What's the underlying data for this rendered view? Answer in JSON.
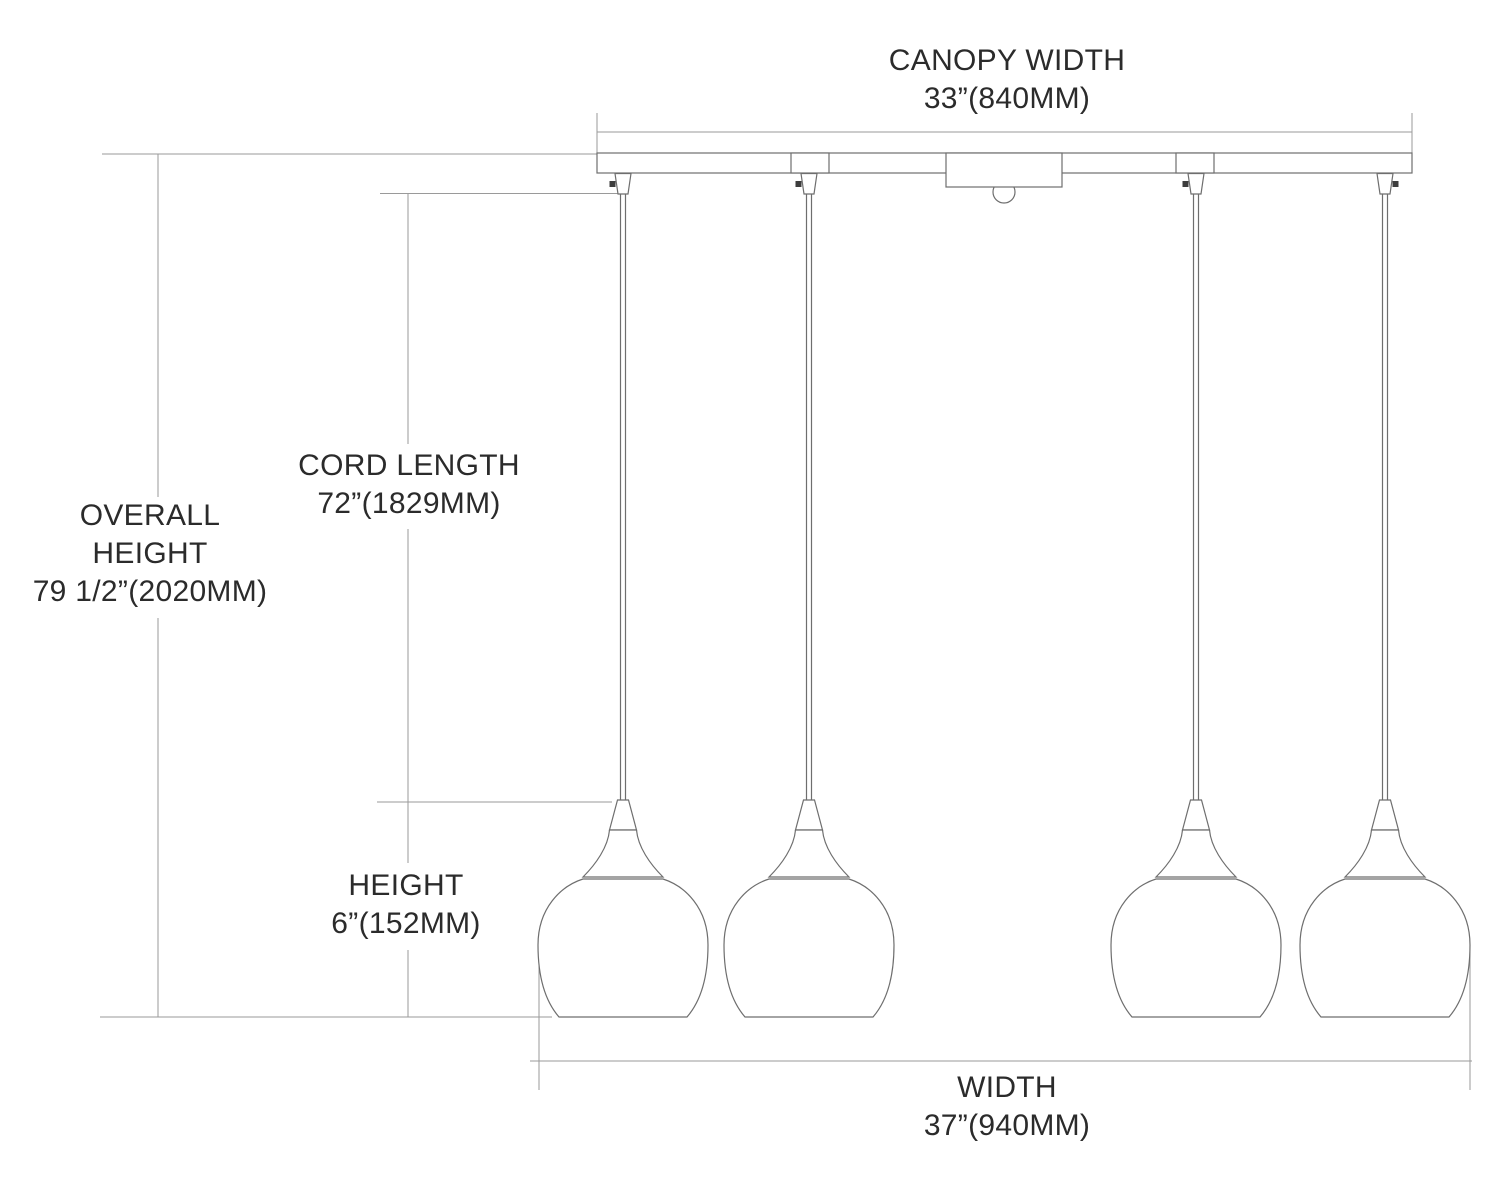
{
  "figure": {
    "pendant_count": 4
  },
  "dimensions": {
    "canopy_width": {
      "label": "CANOPY WIDTH",
      "value": "33”(840MM)"
    },
    "overall_height": {
      "label_line1": "OVERALL",
      "label_line2": "HEIGHT",
      "value": "79 1/2”(2020MM)"
    },
    "cord_length": {
      "label": "CORD LENGTH",
      "value": "72”(1829MM)"
    },
    "shade_height": {
      "label": "HEIGHT",
      "value": "6”(152MM)"
    },
    "width": {
      "label": "WIDTH",
      "value": "37”(940MM)"
    }
  },
  "colors": {
    "background": "#ffffff",
    "object_line": "#6e6e6e",
    "dimension_line": "#9a9a9a",
    "text": "#2b2b2b",
    "bolt": "#3d3d3d"
  }
}
